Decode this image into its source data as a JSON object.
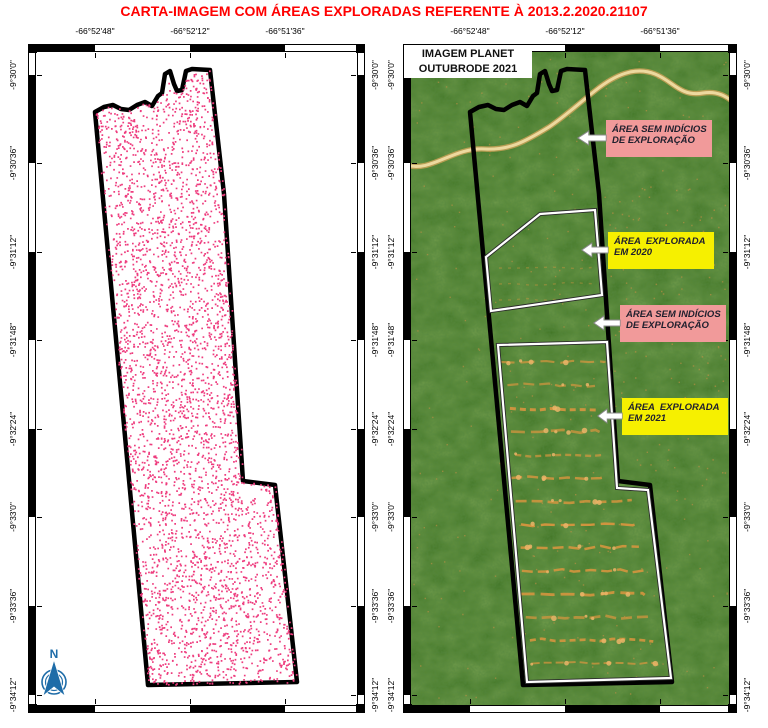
{
  "title": "CARTA-IMAGEM COM ÁREAS EXPLORADAS REFERENTE À 2013.2.2020.21107",
  "colors": {
    "title_red": "#ff0000",
    "dot_pink": "#ee3c7e",
    "pink_label_bg": "#f19a9a",
    "yellow_label_bg": "#f6f000",
    "forest_green": "#3a701e",
    "river_tan": "#edd99f",
    "road_orange": "#d7953f",
    "north_arrow_blue": "#1e6ca8",
    "boundary_black": "#000000",
    "area_outline_white": "#ffffff"
  },
  "axes": {
    "lon_labels": [
      "-66°52'48\"",
      "-66°52'12\"",
      "-66°51'36\""
    ],
    "lat_labels": [
      "-9°30'0\"",
      "-9°30'36\"",
      "-9°31'12\"",
      "-9°31'48\"",
      "-9°32'24\"",
      "-9°33'0\"",
      "-9°33'36\"",
      "-9°34'12\""
    ]
  },
  "left_map": {
    "description": "property boundary filled with inventoried tree points",
    "north_label": "N",
    "dot_count": 3700
  },
  "right_map": {
    "inset_title_line1": "IMAGEM PLANET",
    "inset_title_line2": "OUTUBRODE 2021"
  },
  "annotations": [
    {
      "style": "pink",
      "line1": "ÁREA SEM INDÍCIOS",
      "line2": "DE EXPLORAÇÃO"
    },
    {
      "style": "yellow",
      "line1": "ÁREA  EXPLORADA",
      "line2": "EM 2020"
    },
    {
      "style": "pink",
      "line1": "ÁREA SEM INDÍCIOS",
      "line2": "DE EXPLORAÇÃO"
    },
    {
      "style": "yellow",
      "line1": "ÁREA  EXPLORADA",
      "line2": "EM 2021"
    }
  ]
}
